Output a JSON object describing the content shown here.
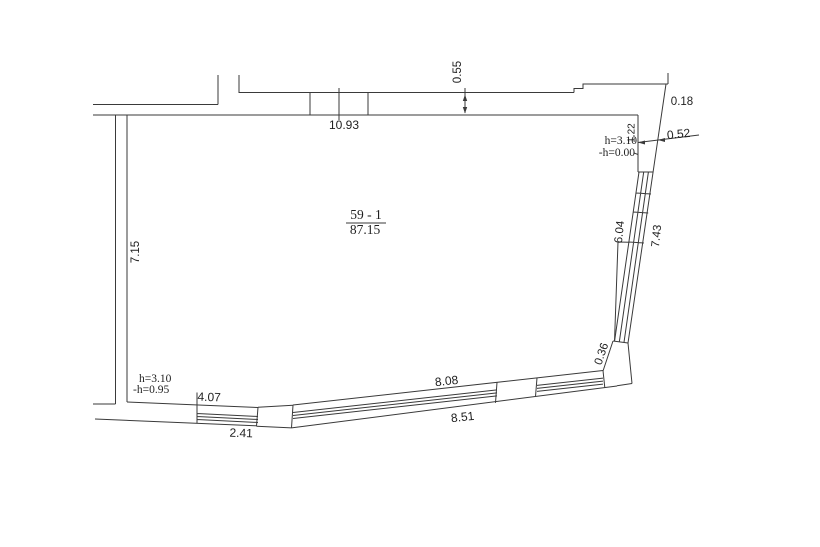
{
  "drawing": {
    "room": {
      "number": "59 - 1",
      "area": "87.15"
    },
    "dims": {
      "top_width": "10.93",
      "top_wall_thickness": "0.55",
      "right_offset": "0.18",
      "right_return": "0.52",
      "right_niche": "1.22",
      "right_glazing_inner": "6.04",
      "right_glazing_outer": "7.43",
      "corner_segment": "0.36",
      "left_wall": "7.15",
      "bottom_left_inner": "4.07",
      "bottom_left_outer": "2.41",
      "bottom_right_inner": "8.08",
      "bottom_right_outer": "8.51"
    },
    "notes": {
      "top_right_height": "h=3.10",
      "top_right_level": "-h=0.00",
      "bottom_left_height": "h=3.10",
      "bottom_left_level": "-h=0.95"
    },
    "colors": {
      "line": "#3a3a3a",
      "text": "#1f1f1f",
      "bg": "#ffffff"
    }
  }
}
